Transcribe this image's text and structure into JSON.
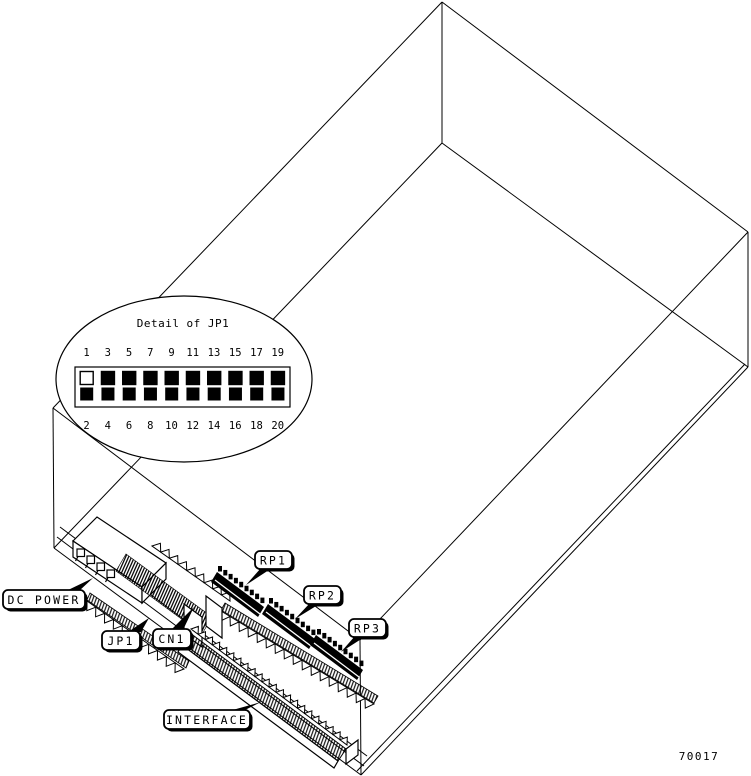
{
  "figure": {
    "kind": "isometric-wireframe-drive-illustration",
    "part_number": "70017",
    "detail_callout": {
      "title": "Detail of JP1",
      "top_pin_labels": [
        "1",
        "3",
        "5",
        "7",
        "9",
        "11",
        "13",
        "15",
        "17",
        "19"
      ],
      "bottom_pin_labels": [
        "2",
        "4",
        "6",
        "8",
        "10",
        "12",
        "14",
        "16",
        "18",
        "20"
      ],
      "open_pin_index": 0
    },
    "component_labels": {
      "dc_power": "DC POWER",
      "jp1": "JP1",
      "cn1": "CN1",
      "rp1": "RP1",
      "rp2": "RP2",
      "rp3": "RP3",
      "interface": "INTERFACE"
    },
    "colors": {
      "ink": "#000000",
      "paper": "#ffffff"
    }
  }
}
